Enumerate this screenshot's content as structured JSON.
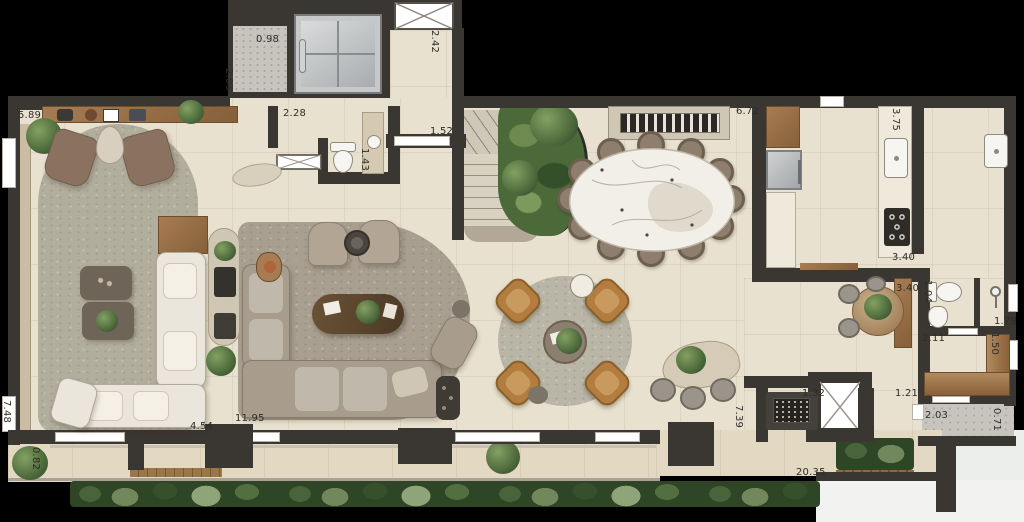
{
  "palette": {
    "background": "#000000",
    "wall": "#3a3631",
    "floor": "#e9e1d0",
    "terrace": "#e3d8c2",
    "concrete": "#c7c4bd",
    "wood": "#a87c52",
    "wood_dark": "#85603a",
    "beige_console": "#cfc6b4",
    "rug": "#b2ae9e",
    "rug_family": "#a89f90",
    "rug_round": "#b9b5a7",
    "sofa_white": "#ebe6db",
    "sofa_taupe": "#a89d8d",
    "armchair_brown": "#8b7260",
    "armchair_tan": "#b2a593",
    "chair_cognac": "#b37d3f",
    "chair_dining": "#8f7e6d",
    "marble": "#f2efe8",
    "plant_dark": "#32492a",
    "plant_mid": "#52703f",
    "plant_light": "#84a063",
    "hedge_base": "#2e4526",
    "fixture_white": "#f6f5f1",
    "grey_metal": "#b4b6b8",
    "label_color": "#2f2d28"
  },
  "dimension_labels": [
    {
      "value": "5.89",
      "x": 18,
      "y": 110,
      "rotated": false
    },
    {
      "value": "0.98",
      "x": 256,
      "y": 34,
      "rotated": false
    },
    {
      "value": "2.03",
      "x": 234,
      "y": 68,
      "rotated": true
    },
    {
      "value": "2.42",
      "x": 440,
      "y": 30,
      "rotated": true
    },
    {
      "value": "2.28",
      "x": 283,
      "y": 108,
      "rotated": false
    },
    {
      "value": "1.52",
      "x": 430,
      "y": 126,
      "rotated": false
    },
    {
      "value": "1.43",
      "x": 370,
      "y": 148,
      "rotated": true
    },
    {
      "value": "6.72",
      "x": 736,
      "y": 106,
      "rotated": false
    },
    {
      "value": "3.75",
      "x": 901,
      "y": 108,
      "rotated": true
    },
    {
      "value": "3.40",
      "x": 892,
      "y": 252,
      "rotated": false
    },
    {
      "value": "3.40",
      "x": 896,
      "y": 283,
      "rotated": false
    },
    {
      "value": "1.04",
      "x": 933,
      "y": 280,
      "rotated": true
    },
    {
      "value": "1.79",
      "x": 994,
      "y": 316,
      "rotated": false
    },
    {
      "value": "2.11",
      "x": 922,
      "y": 333,
      "rotated": false
    },
    {
      "value": "1.50",
      "x": 1000,
      "y": 332,
      "rotated": true
    },
    {
      "value": "1.21",
      "x": 895,
      "y": 388,
      "rotated": false
    },
    {
      "value": "2.03",
      "x": 925,
      "y": 410,
      "rotated": false
    },
    {
      "value": "0.71",
      "x": 1002,
      "y": 408,
      "rotated": true
    },
    {
      "value": "1.32",
      "x": 802,
      "y": 388,
      "rotated": false
    },
    {
      "value": "7.39",
      "x": 744,
      "y": 405,
      "rotated": true
    },
    {
      "value": "20.35",
      "x": 796,
      "y": 467,
      "rotated": false
    },
    {
      "value": "7.48",
      "x": 12,
      "y": 400,
      "rotated": true
    },
    {
      "value": "0.82",
      "x": 41,
      "y": 447,
      "rotated": true
    },
    {
      "value": "4.54",
      "x": 190,
      "y": 421,
      "rotated": false
    },
    {
      "value": "11.95",
      "x": 235,
      "y": 413,
      "rotated": false
    }
  ]
}
